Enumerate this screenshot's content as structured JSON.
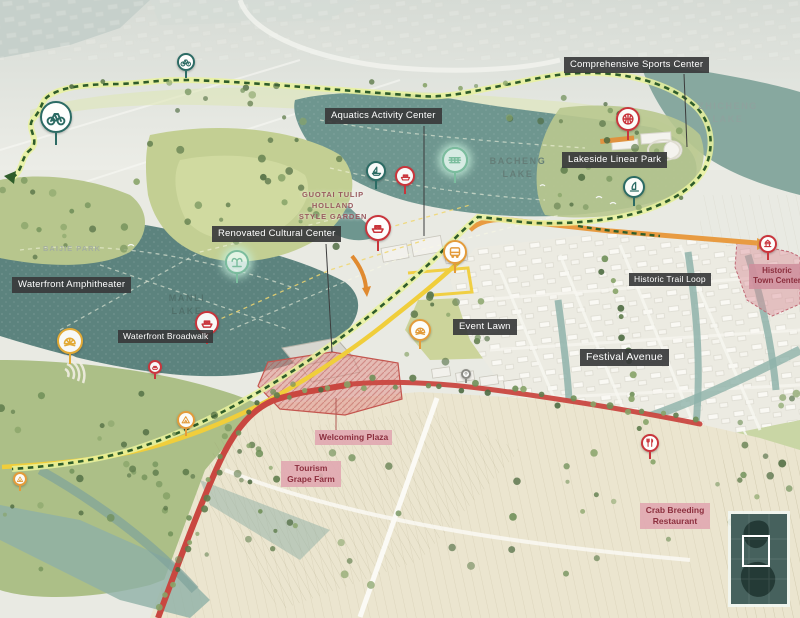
{
  "callouts": [
    {
      "id": "comprehensive-sports-center",
      "text": "Comprehensive Sports Center"
    },
    {
      "id": "aquatics-activity-center",
      "text": "Aquatics Activity Center"
    },
    {
      "id": "lakeside-linear-park",
      "text": "Lakeside Linear Park"
    },
    {
      "id": "renovated-cultural-center",
      "text": "Renovated Cultural Center"
    },
    {
      "id": "waterfront-amphitheater",
      "text": "Waterfront Amphitheater"
    },
    {
      "id": "waterfront-broadwalk",
      "text": "Waterfront Broadwalk"
    },
    {
      "id": "event-lawn",
      "text": "Event Lawn"
    },
    {
      "id": "historic-trail-loop",
      "text": "Historic Trail Loop"
    },
    {
      "id": "festival-avenue",
      "text": "Festival Avenue"
    }
  ],
  "pink_callouts": [
    {
      "id": "welcoming-plaza",
      "text": "Welcoming Plaza"
    },
    {
      "id": "tourism-grape-farm",
      "text": "Tourism Grape Farm"
    },
    {
      "id": "crab-breeding-restaurant",
      "text": "Crab Breeding Restaurant"
    },
    {
      "id": "historic-town-center",
      "text": "Historic Town Center"
    }
  ],
  "place_names": [
    {
      "id": "zhicheng-lake",
      "text": "ZHICHENG LAKE"
    },
    {
      "id": "bacheng-lake",
      "text": "BACHENG LAKE"
    },
    {
      "id": "manli-lake",
      "text": "MANLI LAKE"
    },
    {
      "id": "baijie-park",
      "text": "BAIJIE PARK"
    },
    {
      "id": "guotai-tulip-garden",
      "text": "GUOTAI TULIP HOLLAND STYLE GARDEN"
    }
  ],
  "markers": [
    {
      "type": "bicycle",
      "x": 56,
      "y": 117,
      "r": 16,
      "color": "teal"
    },
    {
      "type": "bicycle",
      "x": 186,
      "y": 62,
      "r": 9,
      "color": "teal"
    },
    {
      "type": "basketball",
      "x": 628,
      "y": 119,
      "r": 12,
      "color": "red"
    },
    {
      "type": "windsurf",
      "x": 634,
      "y": 187,
      "r": 11,
      "color": "teal"
    },
    {
      "type": "sailboat",
      "x": 376,
      "y": 171,
      "r": 10,
      "color": "teal"
    },
    {
      "type": "ferry",
      "x": 405,
      "y": 176,
      "r": 10,
      "color": "red"
    },
    {
      "type": "boat-tour",
      "x": 455,
      "y": 160,
      "r": 13,
      "color": "mint"
    },
    {
      "type": "ferry",
      "x": 378,
      "y": 228,
      "r": 13,
      "color": "red"
    },
    {
      "type": "bus",
      "x": 455,
      "y": 252,
      "r": 12,
      "color": "orange"
    },
    {
      "type": "fountain",
      "x": 237,
      "y": 262,
      "r": 12,
      "color": "mint"
    },
    {
      "type": "ferry",
      "x": 207,
      "y": 323,
      "r": 12,
      "color": "red"
    },
    {
      "type": "ferry",
      "x": 155,
      "y": 367,
      "r": 7,
      "color": "red"
    },
    {
      "type": "amphitheater",
      "x": 70,
      "y": 341,
      "r": 13,
      "color": "yellow"
    },
    {
      "type": "amphitheater",
      "x": 420,
      "y": 330,
      "r": 11,
      "color": "orange"
    },
    {
      "type": "campground",
      "x": 186,
      "y": 420,
      "r": 9,
      "color": "orange"
    },
    {
      "type": "campground",
      "x": 20,
      "y": 479,
      "r": 7,
      "color": "orange"
    },
    {
      "type": "pagoda",
      "x": 768,
      "y": 244,
      "r": 9,
      "color": "red"
    },
    {
      "type": "restaurant",
      "x": 650,
      "y": 443,
      "r": 9,
      "color": "red"
    },
    {
      "type": "location-pin",
      "x": 466,
      "y": 374,
      "r": 5,
      "color": "gray"
    }
  ],
  "colors": {
    "callout_bg": "#38393b",
    "callout_text": "#ffffff",
    "pink_bg": "#e0a6b0",
    "pink_text": "#8c2f3e",
    "trail_green": "#2f5d2a",
    "trail_underlay": "#e9f29e",
    "road_yellow": "#f0ce3b",
    "road_red": "#c94740",
    "road_orange": "#e89b41",
    "lake_teal": "#6e968f",
    "marker_red": "#c9353c",
    "marker_teal": "#2c6b64",
    "marker_orange": "#e39b3a",
    "marker_yellow": "#e2aa35",
    "marker_mint": "#a9d8c2",
    "inset_bg": "#46615d"
  }
}
